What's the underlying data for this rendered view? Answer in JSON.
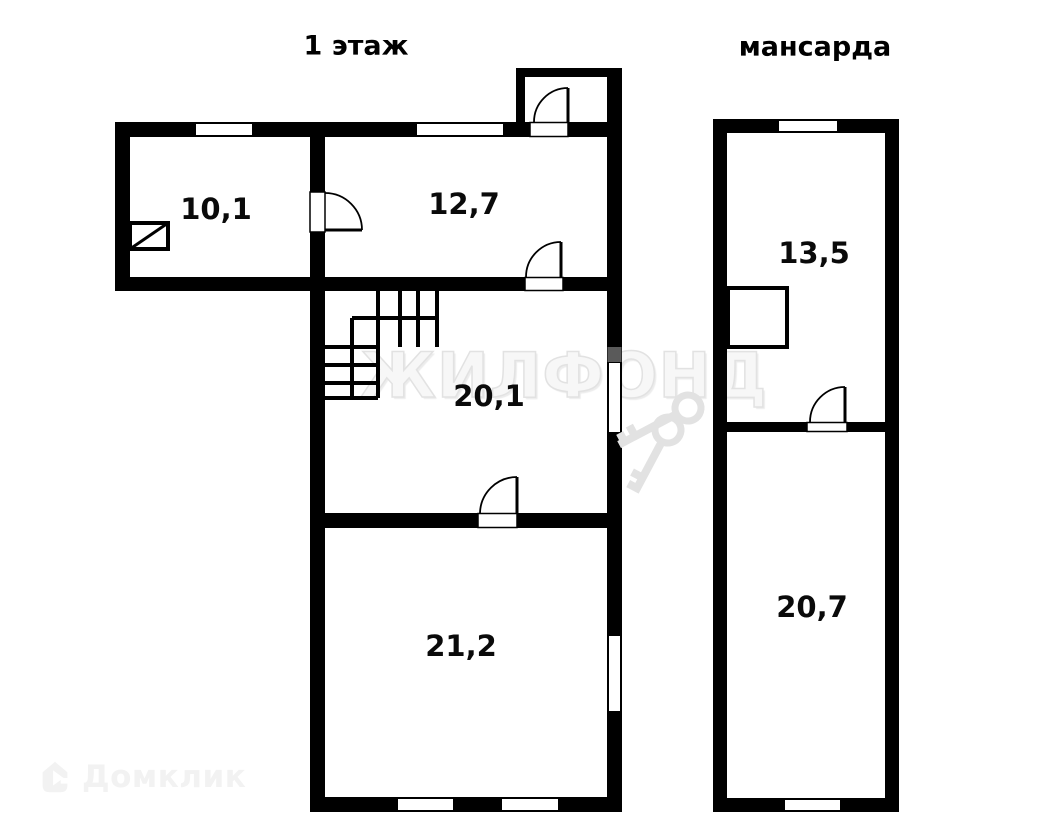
{
  "plans": [
    {
      "title": "1 этаж",
      "rooms": [
        {
          "area": "10,1"
        },
        {
          "area": "12,7"
        },
        {
          "area": "20,1"
        },
        {
          "area": "21,2"
        }
      ]
    },
    {
      "title": "мансарда",
      "rooms": [
        {
          "area": "13,5"
        },
        {
          "area": "20,7"
        }
      ]
    }
  ],
  "watermark": {
    "center_text": "ЖИЛФОНД",
    "corner_text": "Домклик"
  },
  "icons": {
    "keys": "crossed-keys-icon",
    "house": "house-arrow-icon"
  },
  "colors": {
    "wall": "#000000",
    "background": "#ffffff",
    "watermark_text": "#f0f0f0",
    "watermark_keys": "#e2e2e2",
    "domclick_logo": "#f2f2f2",
    "window_vent_gray": "#5a5a5a"
  }
}
